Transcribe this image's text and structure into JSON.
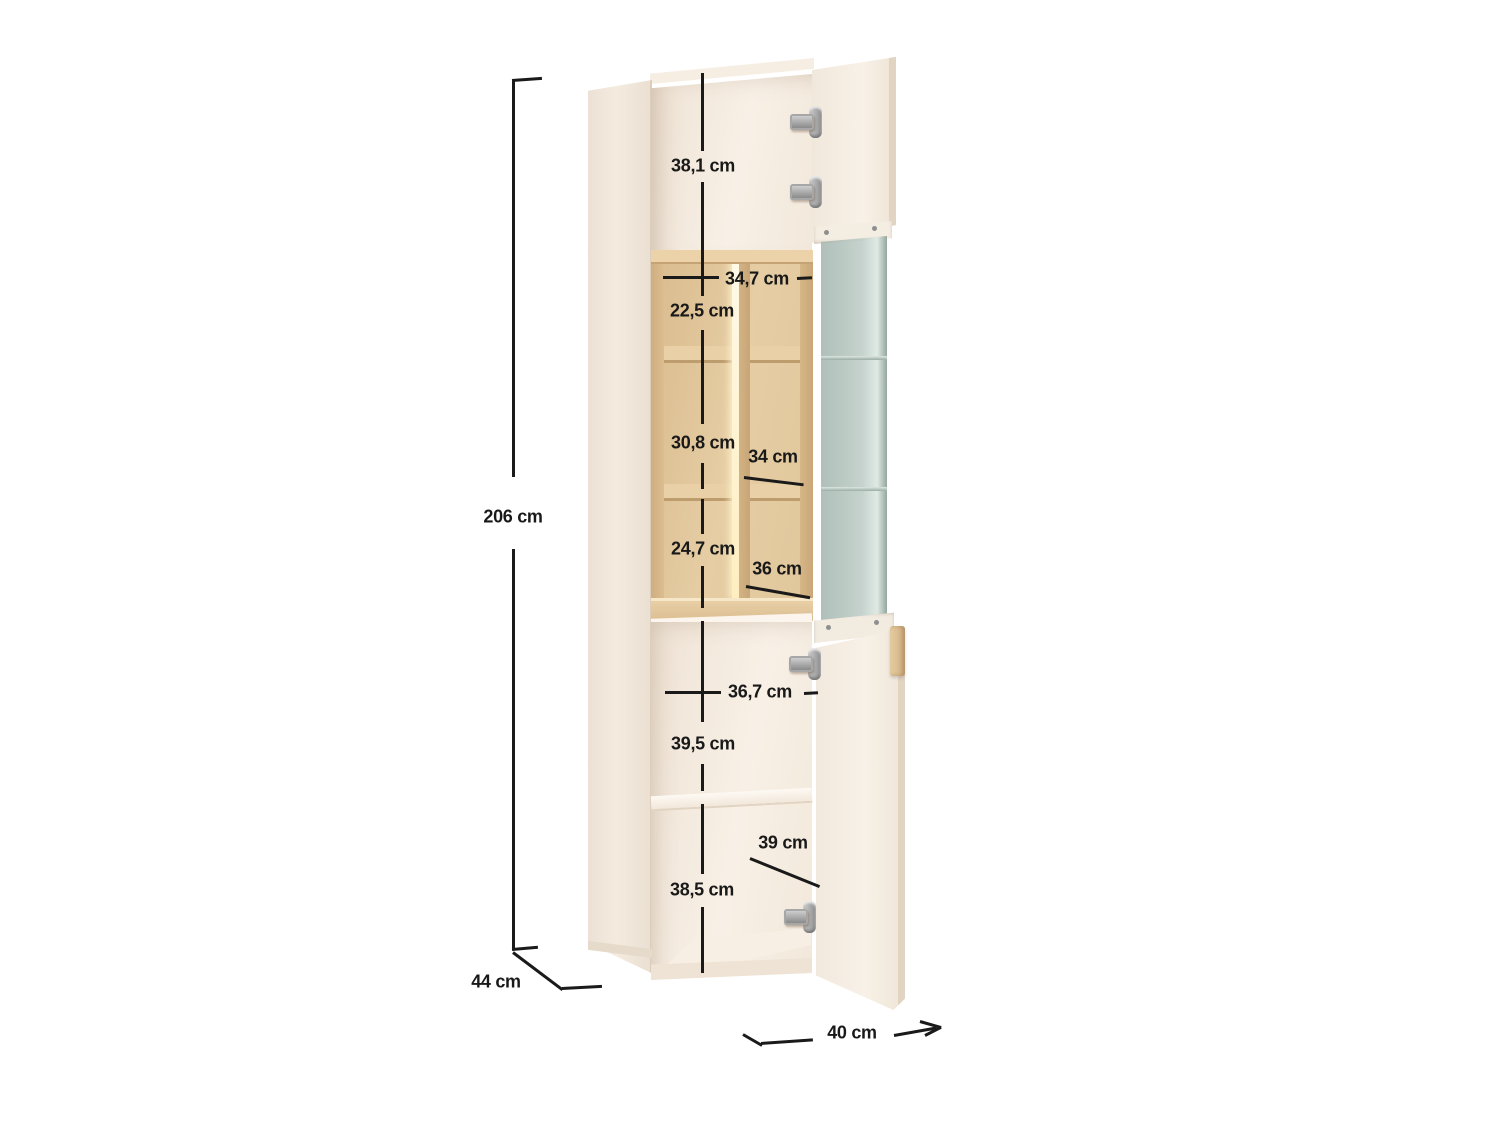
{
  "title": "Tall display cabinet — dimension diagram",
  "unit": "cm",
  "dimensions": {
    "top_section_height": "38,1 cm",
    "upper_inner_width": "34,7 cm",
    "cubby_top_height": "22,5 cm",
    "cubby_middle_height": "30,8 cm",
    "middle_shelf_depth": "34 cm",
    "cubby_bottom_height": "24,7 cm",
    "lower_shelf_depth": "36 cm",
    "lower_inner_width": "36,7 cm",
    "lower_section_height": "39,5 cm",
    "bottom_shelf_depth": "39 cm",
    "bottom_section_height": "38,5 cm",
    "total_height": "206 cm",
    "total_depth": "44 cm",
    "total_width": "40 cm"
  },
  "colors": {
    "body_cream": "#f4ebe1",
    "wood_oak": "#ddc094",
    "glass": "#bdcac5",
    "dimension_line": "#1a1a1a",
    "metal_hinge": "#a9a9a9"
  }
}
